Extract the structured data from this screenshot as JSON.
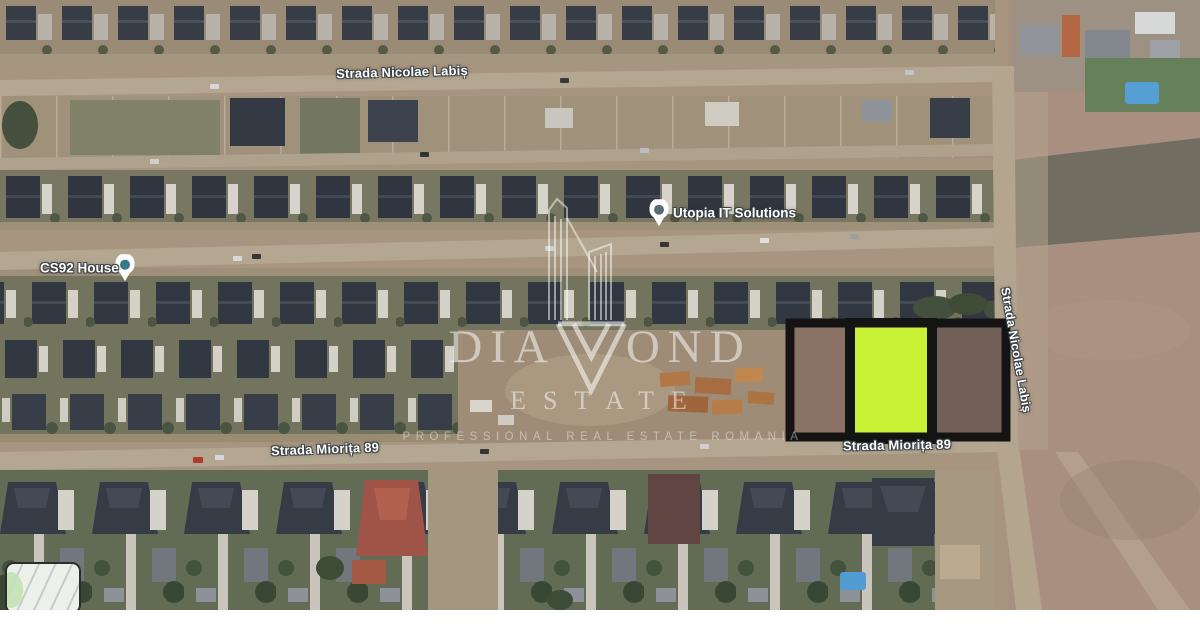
{
  "map": {
    "street_labels": {
      "nicolae_labis_top": "Strada Nicolae Labiș",
      "miorita_left": "Strada Miorița 89",
      "miorita_right": "Strada Miorița 89",
      "nicolae_labis_right": "Strada Nicolae Labiș"
    },
    "pois": {
      "utopia": {
        "label": "Utopia IT Solutions"
      },
      "cs92": {
        "label": "CS92 House"
      }
    },
    "highlight_plot": {
      "fill": "#c8f32e",
      "border": "#0b0b0b"
    }
  },
  "watermark": {
    "brand_left": "DIA",
    "brand_right": "OND",
    "line2": "ESTATE",
    "tagline": "PROFESSIONAL REAL ESTATE ROMANIA"
  }
}
